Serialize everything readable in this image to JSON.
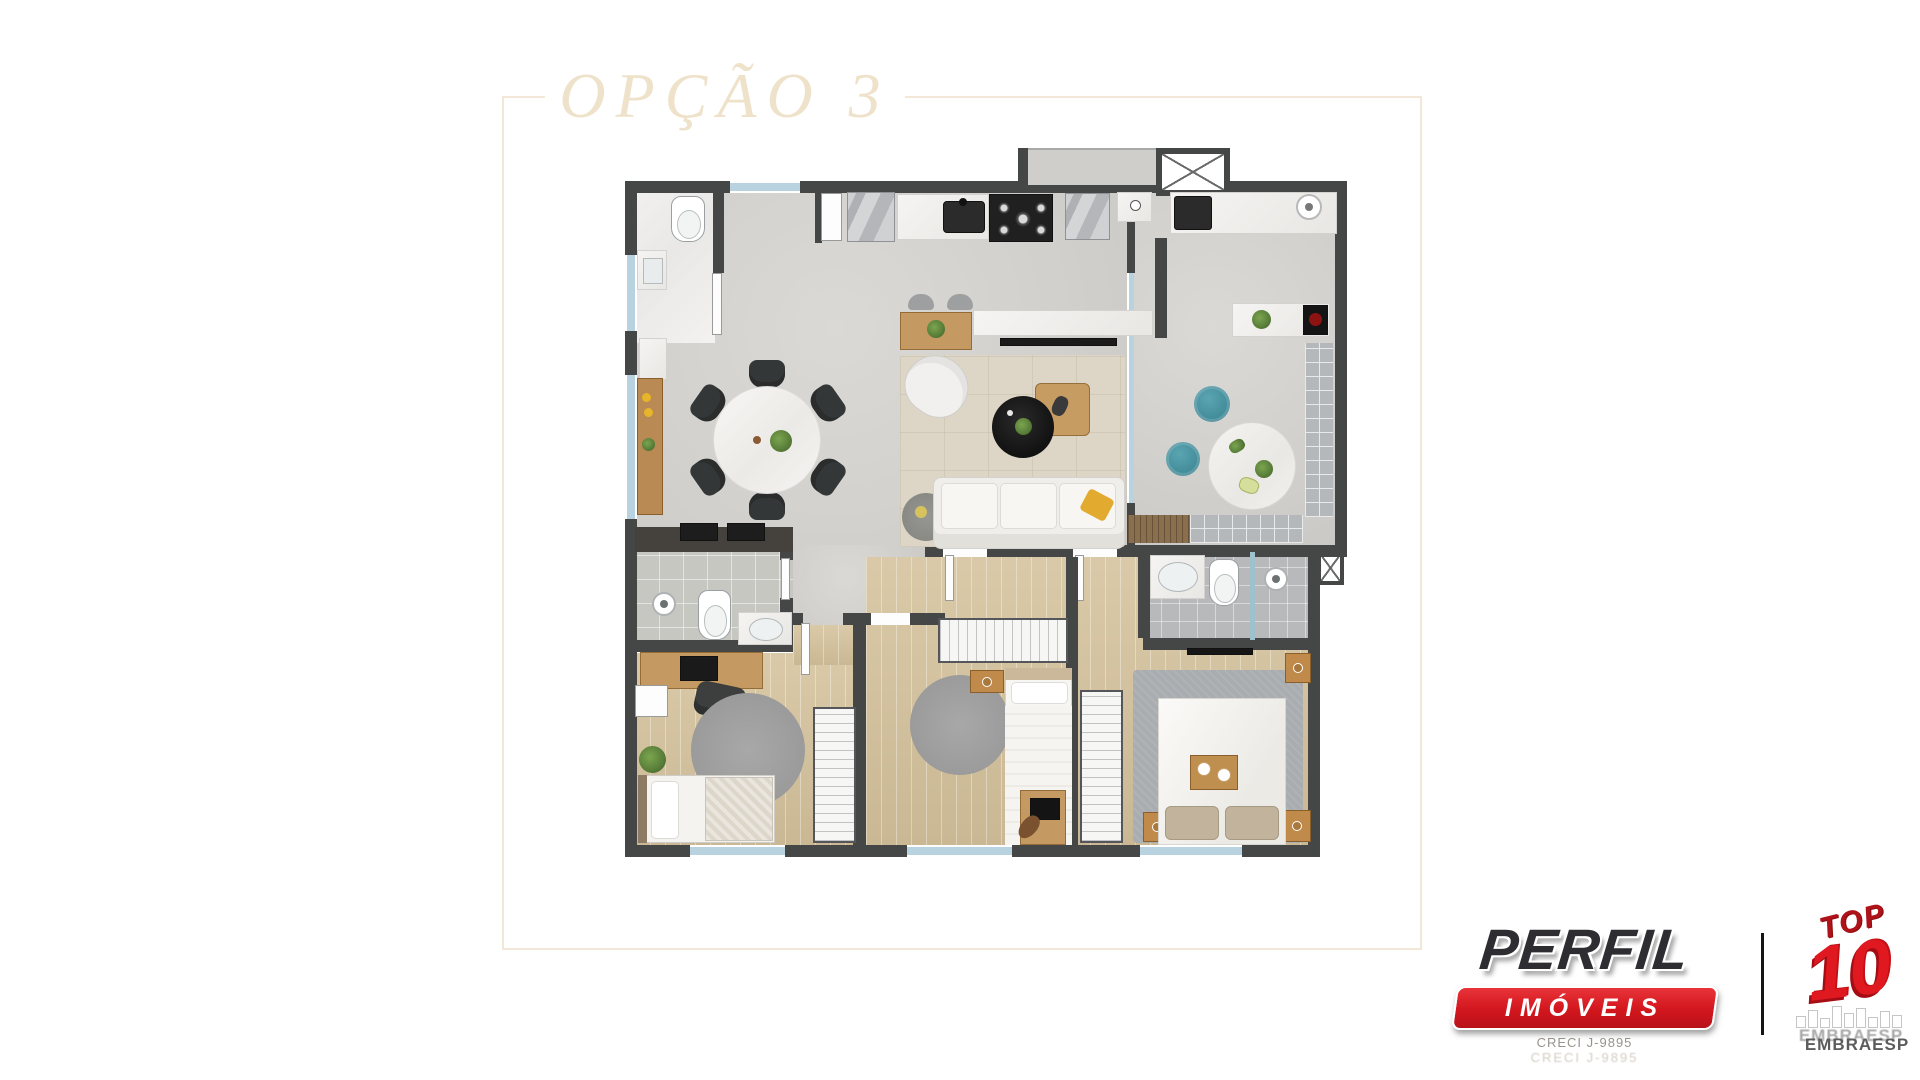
{
  "page": {
    "background_color": "#ffffff"
  },
  "floor_plan": {
    "title": "OPÇÃO 3",
    "frame_color": "#f3e8d7",
    "title_color": "#efe2ca",
    "wall_color": "#454646",
    "plan_icons": [
      "toilet-icon",
      "sink-icon",
      "shower-head-icon",
      "gas-cooktop-icon",
      "induction-cooktop-icon",
      "fridge-icon",
      "washer-icon",
      "laundry-tank-icon",
      "dining-table-icon",
      "dining-chair-icon",
      "sofa-icon",
      "armchair-icon",
      "coffee-table-icon",
      "tv-icon",
      "rug-icon",
      "double-bed-icon",
      "single-bed-icon",
      "wardrobe-icon",
      "desk-icon",
      "office-chair-icon",
      "pouf-icon",
      "round-table-icon",
      "plant-icon",
      "ventilation-shaft-icon",
      "window-icon",
      "door-icon",
      "sideboard-icon",
      "kitchen-counter-icon",
      "breakfast-bar-icon",
      "side-table-icon",
      "deck-mat-icon"
    ]
  },
  "branding": {
    "perfil_logo": {
      "brand": "PERFIL",
      "segment": "IMÓVEIS",
      "license": "CRECI J-9895",
      "brand_color": "#2e2d31",
      "banner_color": "#d3161d"
    },
    "top10_badge": {
      "word_top": "TOP",
      "word_ten": "10",
      "organization": "EMBRAESP",
      "badge_color": "#e01820"
    }
  }
}
